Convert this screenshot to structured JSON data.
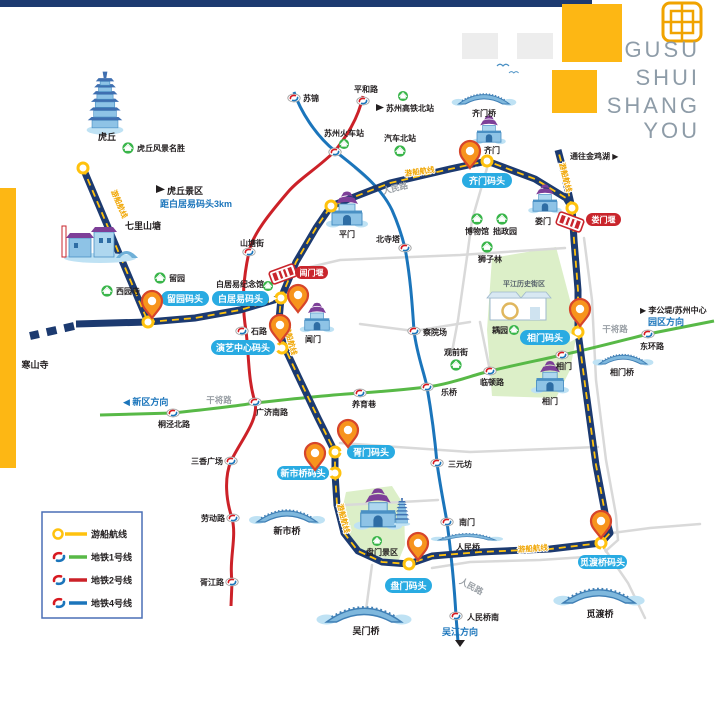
{
  "header": {
    "title_lines": [
      "GUSU",
      "SHUI",
      "SHANG",
      "YOU"
    ]
  },
  "legend": {
    "boat": "游船航线",
    "line1": "地铁1号线",
    "line2": "地铁2号线",
    "line4": "地铁4号线"
  },
  "route": {
    "label": "游船航线"
  },
  "docks": {
    "liuyuan": "留园码头",
    "baijuyi": "白居易码头",
    "yanyi": "演艺中心码头",
    "qimen": "齐门码头",
    "xiangmen": "相门码头",
    "xumen": "胥门码头",
    "xinshiqiao": "新市桥码头",
    "panmen": "盘门码头",
    "miduqiao": "觅渡桥码头"
  },
  "weirs": {
    "changmen": "阊门堰",
    "loumen": "娄门堰"
  },
  "stations": {
    "sujin": "苏锦",
    "pinghelu": "平和路",
    "railway": "苏州火车站",
    "shantangjie": "山塘街",
    "shilu": "石路",
    "guangjinanlu": "广济南路",
    "sanxiangguangchang": "三香广场",
    "laodonglu": "劳动路",
    "xujianglu": "胥江路",
    "tongjingbeilu": "桐泾北路",
    "yangyuxiang": "养育巷",
    "leqiao": "乐桥",
    "lindunlu": "临顿路",
    "xiangmen": "相门",
    "donghuanlu": "东环路",
    "beisita": "北寺塔",
    "chayuanchang": "察院场",
    "sanyuanfang": "三元坊",
    "nanmen": "南门",
    "renminqiaonan": "人民桥南"
  },
  "pois": {
    "huqiu_scenic": "虎丘风景名胜",
    "xiyuansi": "西园寺",
    "liuyuan": "留园",
    "baijuyi_hall": "白居易纪念馆",
    "museum": "博物馆",
    "zhuozhengyuan": "拙政园",
    "shizilin": "狮子林",
    "guanqianjie": "观前街",
    "ouyuan": "耦园",
    "qichebeizhan": "汽车北站",
    "gaotiebeizhan": "苏州高铁北站",
    "panmen_scenic": "盘门景区"
  },
  "landmarks": {
    "huqiu": "虎丘",
    "qilishantang": "七里山塘",
    "hanshansi": "寒山寺",
    "pingmen": "平门",
    "changmen": "阊门",
    "qimen": "齐门",
    "loumen": "娄门",
    "xiangmen_gate": "相门",
    "pingjiang": "平江历史街区",
    "qimenqiao": "齐门桥",
    "xiangmenqiao": "相门桥",
    "renminqiao": "人民桥",
    "wumenqiao": "吴门桥",
    "xinshiqiao": "新市桥",
    "miduqiao": "觅渡桥"
  },
  "roads": {
    "renminlu_top": "人民路",
    "renminlu_bottom": "人民路",
    "ganjianglu_west": "干将路",
    "ganjianglu_east": "干将路"
  },
  "directions": {
    "xinqu": "◀ 新区方向",
    "wujiang": "吴江方向",
    "yuanqu": "园区方向",
    "ligongdi": "▶ 李公堤/苏州中心",
    "jinjihu": "通往金鸡湖 ▶",
    "huqiu_note_title": "虎丘景区",
    "huqiu_note_dist": "距白居易码头3km"
  },
  "colors": {
    "boat_route": "#1c3a70",
    "route_dash": "#ffc20e",
    "metro_line1": "#58b947",
    "metro_line2": "#cc2128",
    "metro_line4": "#1b75bb",
    "dock_pill": "#29abe2",
    "weir_red": "#c9252c",
    "poi_green": "#39b54a",
    "accent_gold": "#fdb714",
    "title_gray": "#8e9ca8"
  }
}
